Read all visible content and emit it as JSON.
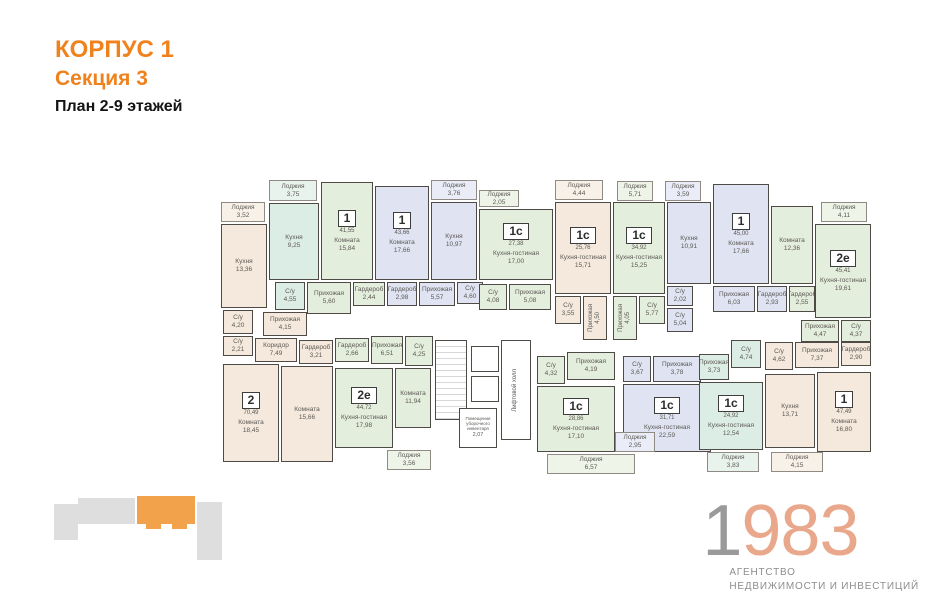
{
  "header": {
    "building": "КОРПУС 1",
    "section": "Секция 3",
    "plan_label": "План 2-9 этажей"
  },
  "colors": {
    "accent_orange": "#f0821e",
    "minimap_orange": "#f2a24b",
    "minimap_gray": "#dedede",
    "beige": "#f4e9dc",
    "green": "#e4eedc",
    "teal": "#dcede5",
    "blue": "#dfe3f2",
    "logo_gray": "#9a9a9a",
    "logo_peach": "#e9a88c"
  },
  "floorplan": {
    "rooms": [
      {
        "n": "Лоджия",
        "a": "3,52",
        "x": 6,
        "y": 52,
        "w": 44,
        "h": 20,
        "c": "b",
        "lodge": 1
      },
      {
        "n": "Лоджия",
        "a": "3,75",
        "x": 54,
        "y": 30,
        "w": 48,
        "h": 21,
        "c": "t",
        "lodge": 1
      },
      {
        "n": "Лоджия",
        "a": "3,76",
        "x": 216,
        "y": 30,
        "w": 46,
        "h": 20,
        "c": "u",
        "lodge": 1
      },
      {
        "n": "Лоджия",
        "a": "2,05",
        "x": 264,
        "y": 40,
        "w": 40,
        "h": 17,
        "c": "g",
        "lodge": 1
      },
      {
        "n": "Лоджия",
        "a": "4,44",
        "x": 340,
        "y": 30,
        "w": 48,
        "h": 20,
        "c": "b",
        "lodge": 1
      },
      {
        "n": "Лоджия",
        "a": "5,71",
        "x": 402,
        "y": 31,
        "w": 36,
        "h": 20,
        "c": "g",
        "lodge": 1
      },
      {
        "n": "Лоджия",
        "a": "3,59",
        "x": 450,
        "y": 31,
        "w": 36,
        "h": 20,
        "c": "u",
        "lodge": 1
      },
      {
        "n": "Лоджия",
        "a": "4,11",
        "x": 606,
        "y": 52,
        "w": 46,
        "h": 20,
        "c": "g",
        "lodge": 1
      },
      {
        "n": "Кухня",
        "a": "13,36",
        "x": 6,
        "y": 74,
        "w": 46,
        "h": 84,
        "c": "b"
      },
      {
        "n": "Кухня",
        "a": "9,25",
        "x": 54,
        "y": 53,
        "w": 50,
        "h": 77,
        "c": "t"
      },
      {
        "badge": "1",
        "ba": "41,55",
        "n": "Комната",
        "a": "15,84",
        "x": 106,
        "y": 32,
        "w": 52,
        "h": 98,
        "c": "g"
      },
      {
        "badge": "1",
        "ba": "43,66",
        "n": "Комната",
        "a": "17,66",
        "x": 160,
        "y": 36,
        "w": 54,
        "h": 94,
        "c": "u"
      },
      {
        "n": "Кухня",
        "a": "10,97",
        "x": 216,
        "y": 52,
        "w": 46,
        "h": 78,
        "c": "u"
      },
      {
        "badge": "1с",
        "ba": "27,38",
        "n": "Кухня-гостиная",
        "a": "17,00",
        "x": 264,
        "y": 59,
        "w": 74,
        "h": 71,
        "c": "g"
      },
      {
        "badge": "1с",
        "ba": "25,76",
        "n": "Кухня-гостиная",
        "a": "15,71",
        "x": 340,
        "y": 52,
        "w": 56,
        "h": 92,
        "c": "b"
      },
      {
        "badge": "1с",
        "ba": "34,92",
        "n": "Кухня-гостиная",
        "a": "15,25",
        "x": 398,
        "y": 52,
        "w": 52,
        "h": 92,
        "c": "g"
      },
      {
        "n": "Кухня",
        "a": "10,91",
        "x": 452,
        "y": 52,
        "w": 44,
        "h": 82,
        "c": "u"
      },
      {
        "badge": "1",
        "ba": "45,00",
        "n": "Комната",
        "a": "17,66",
        "x": 498,
        "y": 34,
        "w": 56,
        "h": 100,
        "c": "u"
      },
      {
        "n": "Комната",
        "a": "12,36",
        "x": 556,
        "y": 56,
        "w": 42,
        "h": 78,
        "c": "g"
      },
      {
        "badge": "2е",
        "ba": "45,41",
        "n": "Кухня-гостиная",
        "a": "19,61",
        "x": 600,
        "y": 74,
        "w": 56,
        "h": 94,
        "c": "g"
      },
      {
        "n": "С/у",
        "a": "4,55",
        "x": 60,
        "y": 132,
        "w": 30,
        "h": 28,
        "c": "t"
      },
      {
        "n": "Прихожая",
        "a": "5,60",
        "x": 92,
        "y": 132,
        "w": 44,
        "h": 32,
        "c": "g"
      },
      {
        "n": "Гардероб",
        "a": "2,44",
        "x": 138,
        "y": 132,
        "w": 32,
        "h": 24,
        "c": "g"
      },
      {
        "n": "Гардероб",
        "a": "2,98",
        "x": 172,
        "y": 132,
        "w": 30,
        "h": 24,
        "c": "u"
      },
      {
        "n": "Прихожая",
        "a": "5,57",
        "x": 204,
        "y": 132,
        "w": 36,
        "h": 24,
        "c": "u"
      },
      {
        "n": "С/у",
        "a": "4,60",
        "x": 242,
        "y": 132,
        "w": 26,
        "h": 22,
        "c": "u"
      },
      {
        "n": "С/у",
        "a": "4,08",
        "x": 264,
        "y": 134,
        "w": 28,
        "h": 26,
        "c": "g"
      },
      {
        "n": "Прихожая",
        "a": "5,08",
        "x": 294,
        "y": 134,
        "w": 42,
        "h": 26,
        "c": "g"
      },
      {
        "n": "С/у",
        "a": "3,55",
        "x": 340,
        "y": 146,
        "w": 26,
        "h": 28,
        "c": "b"
      },
      {
        "n": "Прихожая",
        "a": "4,50",
        "x": 368,
        "y": 146,
        "w": 24,
        "h": 44,
        "c": "b",
        "v": 1
      },
      {
        "n": "Прихожая",
        "a": "4,05",
        "x": 398,
        "y": 146,
        "w": 24,
        "h": 44,
        "c": "g",
        "v": 1
      },
      {
        "n": "С/у",
        "a": "5,77",
        "x": 424,
        "y": 146,
        "w": 26,
        "h": 28,
        "c": "g"
      },
      {
        "n": "С/у",
        "a": "2,02",
        "x": 452,
        "y": 136,
        "w": 26,
        "h": 20,
        "c": "u"
      },
      {
        "n": "С/у",
        "a": "5,04",
        "x": 452,
        "y": 158,
        "w": 26,
        "h": 24,
        "c": "u"
      },
      {
        "n": "Прихожая",
        "a": "6,03",
        "x": 498,
        "y": 136,
        "w": 42,
        "h": 26,
        "c": "u"
      },
      {
        "n": "Гардероб",
        "a": "2,93",
        "x": 542,
        "y": 136,
        "w": 30,
        "h": 26,
        "c": "u"
      },
      {
        "n": "Гардероб",
        "a": "2,55",
        "x": 574,
        "y": 136,
        "w": 26,
        "h": 26,
        "c": "g"
      },
      {
        "n": "Прихожая",
        "a": "4,47",
        "x": 586,
        "y": 170,
        "w": 38,
        "h": 22,
        "c": "g"
      },
      {
        "n": "С/у",
        "a": "4,37",
        "x": 626,
        "y": 170,
        "w": 30,
        "h": 22,
        "c": "g"
      },
      {
        "n": "С/у",
        "a": "4,20",
        "x": 8,
        "y": 160,
        "w": 30,
        "h": 24,
        "c": "b"
      },
      {
        "n": "Прихожая",
        "a": "4,15",
        "x": 48,
        "y": 162,
        "w": 44,
        "h": 24,
        "c": "b"
      },
      {
        "n": "С/у",
        "a": "2,21",
        "x": 8,
        "y": 186,
        "w": 30,
        "h": 20,
        "c": "b"
      },
      {
        "n": "Коридор",
        "a": "7,49",
        "x": 40,
        "y": 188,
        "w": 42,
        "h": 24,
        "c": "b"
      },
      {
        "n": "Гардероб",
        "a": "3,21",
        "x": 84,
        "y": 190,
        "w": 34,
        "h": 24,
        "c": "b"
      },
      {
        "badge": "2",
        "ba": "70,49",
        "n": "Комната",
        "a": "18,45",
        "x": 8,
        "y": 214,
        "w": 56,
        "h": 98,
        "c": "b"
      },
      {
        "n": "Комната",
        "a": "15,66",
        "x": 66,
        "y": 216,
        "w": 52,
        "h": 96,
        "c": "b"
      },
      {
        "n": "Гардероб",
        "a": "2,66",
        "x": 120,
        "y": 188,
        "w": 34,
        "h": 24,
        "c": "g"
      },
      {
        "n": "Прихожая",
        "a": "6,51",
        "x": 156,
        "y": 186,
        "w": 32,
        "h": 28,
        "c": "g"
      },
      {
        "n": "С/у",
        "a": "4,25",
        "x": 190,
        "y": 186,
        "w": 28,
        "h": 30,
        "c": "g"
      },
      {
        "badge": "2е",
        "ba": "44,72",
        "n": "Кухня-гостиная",
        "a": "17,98",
        "x": 120,
        "y": 218,
        "w": 58,
        "h": 80,
        "c": "g"
      },
      {
        "n": "Комната",
        "a": "11,94",
        "x": 180,
        "y": 218,
        "w": 36,
        "h": 60,
        "c": "g"
      },
      {
        "n": "Лоджия",
        "a": "3,56",
        "x": 172,
        "y": 300,
        "w": 44,
        "h": 20,
        "c": "g",
        "lodge": 1
      },
      {
        "n": "",
        "x": 220,
        "y": 190,
        "w": 32,
        "h": 80,
        "c": "w",
        "stairs": 1
      },
      {
        "n": "",
        "x": 256,
        "y": 196,
        "w": 28,
        "h": 26,
        "c": "w"
      },
      {
        "n": "",
        "x": 256,
        "y": 226,
        "w": 28,
        "h": 26,
        "c": "w"
      },
      {
        "n": "Помещение уборочного инвентаря",
        "a": "2,07",
        "x": 244,
        "y": 258,
        "w": 38,
        "h": 40,
        "c": "w",
        "tiny": 1
      },
      {
        "n": "Лифтовой холл",
        "x": 286,
        "y": 190,
        "w": 30,
        "h": 100,
        "c": "w",
        "v": 1
      },
      {
        "n": "С/у",
        "a": "4,32",
        "x": 322,
        "y": 206,
        "w": 28,
        "h": 28,
        "c": "g"
      },
      {
        "n": "Прихожая",
        "a": "4,19",
        "x": 352,
        "y": 202,
        "w": 48,
        "h": 28,
        "c": "g"
      },
      {
        "badge": "1с",
        "ba": "28,86",
        "n": "Кухня-гостиная",
        "a": "17,10",
        "x": 322,
        "y": 236,
        "w": 78,
        "h": 66,
        "c": "g"
      },
      {
        "n": "Лоджия",
        "a": "6,57",
        "x": 332,
        "y": 304,
        "w": 88,
        "h": 20,
        "c": "g",
        "lodge": 1
      },
      {
        "n": "С/у",
        "a": "3,67",
        "x": 408,
        "y": 206,
        "w": 28,
        "h": 26,
        "c": "u"
      },
      {
        "n": "Прихожая",
        "a": "3,78",
        "x": 438,
        "y": 206,
        "w": 48,
        "h": 26,
        "c": "u"
      },
      {
        "badge": "1с",
        "ba": "31,71",
        "n": "Кухня-гостиная",
        "a": "22,59",
        "x": 408,
        "y": 234,
        "w": 88,
        "h": 68,
        "c": "u"
      },
      {
        "n": "Лоджия",
        "a": "2,95",
        "x": 400,
        "y": 282,
        "w": 40,
        "h": 20,
        "c": "u",
        "lodge": 1
      },
      {
        "n": "Прихожая",
        "a": "3,73",
        "x": 484,
        "y": 204,
        "w": 30,
        "h": 26,
        "c": "t"
      },
      {
        "n": "С/у",
        "a": "4,74",
        "x": 516,
        "y": 190,
        "w": 30,
        "h": 28,
        "c": "t"
      },
      {
        "badge": "1с",
        "ba": "24,92",
        "n": "Кухня-гостиная",
        "a": "12,54",
        "x": 484,
        "y": 232,
        "w": 64,
        "h": 68,
        "c": "t"
      },
      {
        "n": "Лоджия",
        "a": "3,83",
        "x": 492,
        "y": 302,
        "w": 52,
        "h": 20,
        "c": "t",
        "lodge": 1
      },
      {
        "n": "С/у",
        "a": "4,62",
        "x": 550,
        "y": 192,
        "w": 28,
        "h": 28,
        "c": "b"
      },
      {
        "n": "Прихожая",
        "a": "7,37",
        "x": 580,
        "y": 192,
        "w": 44,
        "h": 26,
        "c": "b"
      },
      {
        "n": "Гардероб",
        "a": "2,90",
        "x": 626,
        "y": 192,
        "w": 30,
        "h": 24,
        "c": "b"
      },
      {
        "n": "Кухня",
        "a": "13,71",
        "x": 550,
        "y": 224,
        "w": 50,
        "h": 74,
        "c": "b"
      },
      {
        "badge": "1",
        "ba": "47,49",
        "n": "Комната",
        "a": "16,80",
        "x": 602,
        "y": 222,
        "w": 54,
        "h": 80,
        "c": "b"
      },
      {
        "n": "Лоджия",
        "a": "4,15",
        "x": 556,
        "y": 302,
        "w": 52,
        "h": 20,
        "c": "b",
        "lodge": 1
      }
    ]
  },
  "logo": {
    "year_gray": "1",
    "year_peach": "983",
    "sub_line1": "АГЕНТСТВО",
    "sub_line2": "НЕДВИЖИМОСТИ И ИНВЕСТИЦИЙ"
  }
}
